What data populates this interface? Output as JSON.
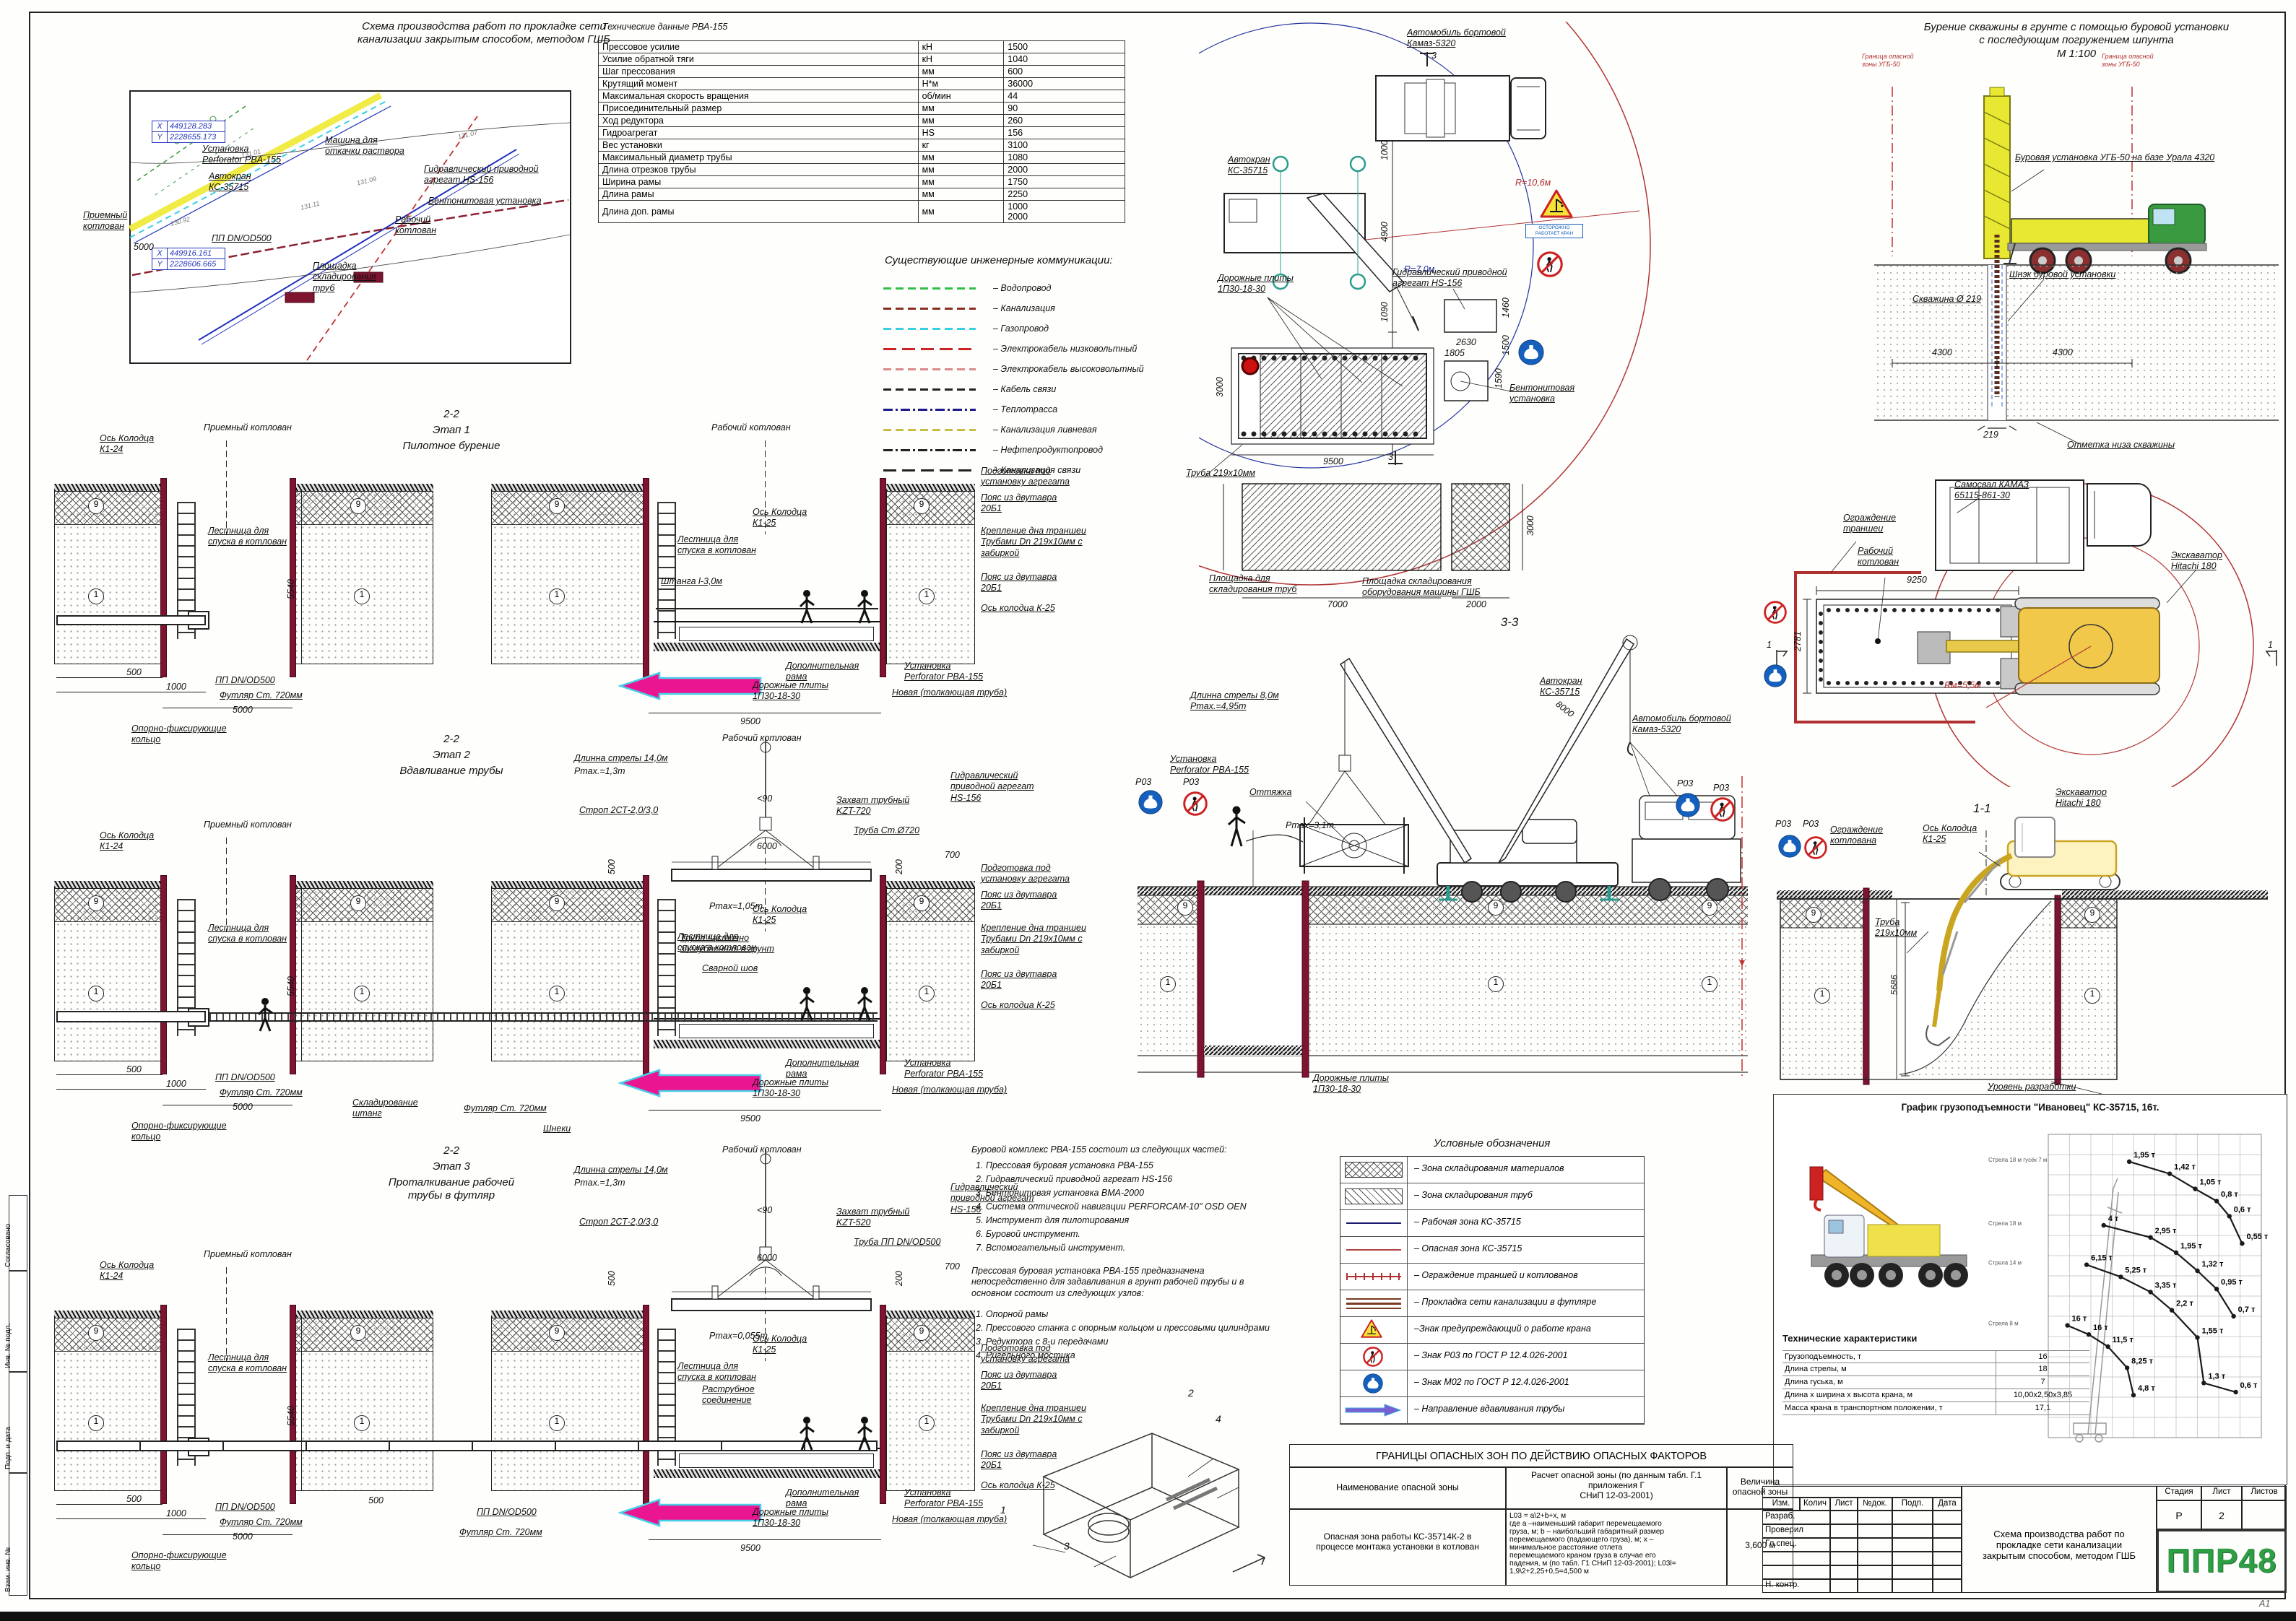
{
  "sheet": {
    "format": "А1"
  },
  "site_plan": {
    "title": "Схема производства работ по прокладке сети\nканализации закрытым способом, методом ГШБ",
    "coord_box1": {
      "x_label": "X",
      "x": "449128.283",
      "y_label": "Y",
      "y": "2228655.173"
    },
    "coord_box2": {
      "x_label": "X",
      "x": "449916.161",
      "y_label": "Y",
      "y": "2228606.665"
    },
    "labels": {
      "pump": "Машина для\nоткачки раствора",
      "perforator": "Установка\nPerforator PBA-155",
      "crane": "Автокран\nКС-35715",
      "hydro": "Гидравлический приводной\nагрегат HS-156",
      "bentonite": "Бентонитовая установка",
      "work_pit": "Рабочий\nкотлован",
      "recv_pit": "Приемный\nкотлован",
      "pp": "ПП DN/OD500",
      "storage": "Площадка\nскладирования\nтруб",
      "dim5000": "5000"
    },
    "spots": [
      "131.01",
      "131.11",
      "130.92",
      "131.07",
      "131.09"
    ]
  },
  "tech_table": {
    "title": "Технические данные РВА-155",
    "rows": [
      [
        "Прессовое усилие",
        "кН",
        "1500"
      ],
      [
        "Усилие обратной тяги",
        "кН",
        "1040"
      ],
      [
        "Шаг прессования",
        "мм",
        "600"
      ],
      [
        "Крутящий момент",
        "Н*м",
        "36000"
      ],
      [
        "Максимальная скорость вращения",
        "об/мин",
        "44"
      ],
      [
        "Присоединительный размер",
        "мм",
        "90"
      ],
      [
        "Ход редуктора",
        "мм",
        "260"
      ],
      [
        "Гидроагрегат",
        "HS",
        "156"
      ],
      [
        "Вес установки",
        "кг",
        "3100"
      ],
      [
        "Максимальный диаметр трубы",
        "мм",
        "1080"
      ],
      [
        "Длина отрезков трубы",
        "мм",
        "2000"
      ],
      [
        "Ширина рамы",
        "мм",
        "1750"
      ],
      [
        "Длина рамы",
        "мм",
        "2250"
      ],
      [
        "Длина доп. рамы",
        "мм",
        "1000\n2000"
      ]
    ]
  },
  "comms_legend": {
    "title": "Существующие инженерные коммуникации:",
    "items": [
      {
        "label": "– Водопровод",
        "color": "#2fbf4a",
        "style": "dash"
      },
      {
        "label": "– Канализация",
        "color": "#8a3020",
        "style": "dash"
      },
      {
        "label": "– Газопровод",
        "color": "#38cfe0",
        "style": "dash"
      },
      {
        "label": "– Электрокабель  низковольтный",
        "color": "#cc2525",
        "style": "longdash"
      },
      {
        "label": "– Электрокабель  высоковольтный",
        "color": "#d98a8a",
        "style": "dash"
      },
      {
        "label": "– Кабель  связи",
        "color": "#222222",
        "style": "dash"
      },
      {
        "label": "– Теплотрасса",
        "color": "#1a1a8c",
        "style": "dashdot"
      },
      {
        "label": "– Канализация  ливневая",
        "color": "#c9bc45",
        "style": "dash"
      },
      {
        "label": "– Нефтепродуктопровод",
        "color": "#222222",
        "style": "dashdot"
      },
      {
        "label": "– Канализация  связи",
        "color": "#222222",
        "style": "longdash"
      }
    ]
  },
  "plan_view": {
    "kamaz": "Автомобиль  бортовой\nКамаз-5320",
    "sec3": "3",
    "crane": "Автокран\nКС-35715",
    "plates": "Дорожные плиты\n1П30-18-30",
    "hydro": "Гидравлический приводной\nагрегат HS-156",
    "r_red": "R=10,6м",
    "r_blue": "R=7,0м",
    "truba": "Труба 219x10мм",
    "storage_pipes": "Площадка для\nскладирования  труб",
    "storage_equip": "Площадка складирования\nоборудования машины ГШБ",
    "bentonite": "Бентонитовая\nустановка",
    "warn_caption": "ОСТОРОЖНО\nРАБОТАЕТ КРАН",
    "d1000": "1000",
    "d4900": "4900",
    "d1090": "1090",
    "d9500": "9500",
    "d3000": "3000",
    "d2630": "2630",
    "d1460": "1460",
    "d1805": "1805",
    "d1500": "1500",
    "d1590": "1590",
    "d7000": "7000",
    "d2000": "2000"
  },
  "drill_view": {
    "title": "Бурение скважины в грунте с помощью буровой установки\nс последующим погружением шпунта\nМ 1:100",
    "rig": "Буровая установка УГБ-50 на базе Урала 4320",
    "auger": "Шнэк буровой установки",
    "well": "Скважина Ø 219",
    "bottom": "Отметка низа скважины",
    "bound": "Граница опасной\nзоны УГБ-50",
    "d4300a": "4300",
    "d4300b": "4300",
    "d219": "219"
  },
  "stage_common": {
    "priem": "Приемный котлован",
    "rab": "Рабочий котлован",
    "os24": "Ось  Колодца\nК1-24",
    "os25": "Ось  Колодца\nК1-25",
    "ladder": "Лестница для\nспуска в котлован",
    "d500": "500",
    "d1000": "1000",
    "d5000": "5000",
    "d5540": "5540",
    "d9500": "9500",
    "pp": "ПП DN/OD500",
    "futlyar": "Футляр Ст. 720мм",
    "ring": "Опорно-фиксирующие\nкольцо",
    "dop_rama": "Дополнительная\nрама",
    "plates": "Дорожные плиты\n1П30-18-30",
    "unit": "Установка\nPerforator PBA-155",
    "unit2": "Новая (толкающая труба)",
    "note1": "Подготовка под\nустановку агрегата",
    "note2": "Пояс из двутавра\n20Б1",
    "note3": "Крепление дна траншеи\nТрубами Dn 219x10мм с\nзабиркой",
    "note4": "Пояс из двутавра\n20Б1",
    "os_k25": "Ось колодца К-25",
    "g9": "9",
    "g1": "1"
  },
  "stages": [
    {
      "code": "2-2",
      "name": "Этап 1",
      "desc": "Пилотное бурение",
      "shtanga": "Штанга l-3,0м"
    },
    {
      "code": "2-2",
      "name": "Этап 2",
      "desc": "Вдавливание трубы",
      "boom": "Длинна стрелы 14,0м",
      "pmax_hook": "Pmax.=1,3m",
      "strop": "Строп 2СТ-2,0/3,0",
      "angle": "<90",
      "zahvat": "Захват трубный\nKZT-720",
      "truba": "Труба Ст.Ø720",
      "hs": "Гидравлический\nприводной агрегат\nHS-156",
      "d6000": "6000",
      "d500b": "500",
      "d200": "200",
      "d700": "700",
      "pmax_in": "Pmax=1,05m.",
      "truba_part": "Труба частично\nзаглубленная в грунт",
      "svar": "Сварной шов",
      "sklad": "Складирование\nштанг",
      "futlyar2": "Футляр Ст. 720мм",
      "shneki": "Шнеки"
    },
    {
      "code": "2-2",
      "name": "Этап 3",
      "desc": "Проталкивание рабочей\nтрубы в футляр",
      "boom": "Длинна стрелы 14,0м",
      "pmax_hook": "Pmax.=1,3m",
      "strop": "Строп 2СТ-2,0/3,0",
      "angle": "<90",
      "zahvat": "Захват трубный\nKZT-520",
      "truba": "Труба ПП DN/OD500",
      "hs": "Гидравлический\nприводной агрегат\nHS-156",
      "d6000": "6000",
      "d500b": "500",
      "d200": "200",
      "d700": "700",
      "pmax_in": "Pmax=0,055m.",
      "rastrub": "Раструбное\nсоединение",
      "pp2": "ПП DN/OD500",
      "futlyar2": "Футляр Ст. 720мм",
      "d500c": "500"
    }
  ],
  "section33": {
    "title": "3-3",
    "boom_note": "Длинна стрелы 8,0м\nPmax.=4,95m",
    "d8000": "8000",
    "crane": "Автокран\nКС-35715",
    "kamaz": "Автомобиль  бортовой\nКамаз-5320",
    "unit": "Установка\nPerforator PBA-155",
    "guy": "Оттяжка",
    "pmax": "Pmax=3,1m.",
    "p03": "Р03",
    "plates": "Дорожные плиты\n1П30-18-30",
    "g9": "9",
    "g1": "1"
  },
  "excavator_plan": {
    "samosval": "Самосвал  КАМАЗ\n65115-861-30",
    "fence": "Ограждение\nтраншеи",
    "pit": "Рабочий\nкотлован",
    "excavator": "Экскаватор\nHitachi  180",
    "d9250": "9250",
    "d2781": "2781",
    "radius": "Rм=5,5м",
    "mark": "1"
  },
  "section11": {
    "title": "1-1",
    "axis": "Ось  Колодца\nК1-25",
    "excavator": "Экскаватор\nHitachi  180",
    "p03": "Р03",
    "fence": "Ограждение\nкотлована",
    "pipe": "Труба\n219х10мм",
    "d5686": "5686",
    "level": "Уровень разработки",
    "g9": "9",
    "g1": "1"
  },
  "symbols_legend": {
    "title": "Условные обозначения",
    "items": [
      {
        "label": "– Зона складирования материалов",
        "type": "xhatch"
      },
      {
        "label": "– Зона складирования труб",
        "type": "diag"
      },
      {
        "label": "– Рабочая зона КС-35715",
        "type": "line_navy"
      },
      {
        "label": "– Опасная зона КС-35715",
        "type": "line_red"
      },
      {
        "label": "– Ограждение траншей и котлованов",
        "type": "fence"
      },
      {
        "label": "– Прокладка сети канализации в футляре",
        "type": "triple"
      },
      {
        "label": "–Знак предупреждающий о работе крана",
        "type": "warn"
      },
      {
        "label": "– Знак Р03 по ГОСТ Р 12.4.026-2001",
        "type": "p03"
      },
      {
        "label": "– Знак М02 по ГОСТ Р 12.4.026-2001",
        "type": "m02"
      },
      {
        "label": "– Направление вдавливания трубы",
        "type": "arrow"
      }
    ]
  },
  "complex_text": {
    "head": "Буровой комплекс РВА-155 состоит из следующих частей:",
    "items": [
      "1. Прессовая буровая установка РВА-155",
      "2. Гидравлический приводной агрегат HS-156",
      "3. Бентонитовая установка  ВМА-2000",
      "4. Система оптической навигации PERFORCAM-10\" OSD OEN",
      "5. Инструмент для пилотирования",
      "6. Буровой инструмент.",
      "7. Вспомогательный инструмент."
    ],
    "head2": "Прессовая буровая установка РВА-155 предназначена\nнепосредственно для задавливания в грунт рабочей трубы и в\nосновном состоит из следующих узлов:",
    "items2": [
      "1. Опорной рамы",
      "2. Прессового станка с опорным кольцом и прессовыми цилиндрами",
      "3. Редуктора с 8-и передачами",
      "4. Ригельного мостика"
    ],
    "marks": [
      "1",
      "2",
      "3",
      "4"
    ]
  },
  "chart_data": {
    "type": "line",
    "title": "График грузоподъемности \"Ивановец\" КС-35715, 16т.",
    "xlabel": "вылет, м",
    "ylabel": "высота, м",
    "legend_position": "left",
    "grid": true,
    "series": [
      {
        "name": "Стрела 18 м\nгусёк 7 м",
        "points": [
          [
            38,
            9,
            "1,95 т"
          ],
          [
            57,
            13,
            "1,42 т"
          ],
          [
            69,
            18,
            "1,05 т"
          ],
          [
            79,
            22,
            "0,8 т"
          ],
          [
            85,
            27,
            "0,6 т"
          ],
          [
            91,
            36,
            "0,55 т"
          ]
        ]
      },
      {
        "name": "Стрела 18 м",
        "points": [
          [
            26,
            30,
            "4 т"
          ],
          [
            48,
            34,
            "2,95 т"
          ],
          [
            60,
            39,
            "1,95 т"
          ],
          [
            70,
            45,
            "1,32 т"
          ],
          [
            79,
            51,
            "0,95 т"
          ],
          [
            87,
            60,
            "0,7 т"
          ]
        ]
      },
      {
        "name": "Стрела 14 м",
        "points": [
          [
            18,
            43,
            "6,15 т"
          ],
          [
            34,
            47,
            "5,25 т"
          ],
          [
            48,
            52,
            "3,35 т"
          ],
          [
            58,
            58,
            "2,2 т"
          ],
          [
            70,
            67,
            "1,55 т"
          ],
          [
            73,
            82,
            "1,3 т"
          ],
          [
            88,
            85,
            "0,6 т"
          ]
        ]
      },
      {
        "name": "Стрела 8 м",
        "points": [
          [
            9,
            63,
            "16 т"
          ],
          [
            19,
            66,
            "16 т"
          ],
          [
            28,
            70,
            "11,5 т"
          ],
          [
            37,
            77,
            "8,25 т"
          ],
          [
            40,
            86,
            "4,8 т"
          ]
        ]
      }
    ]
  },
  "crane_specs": {
    "title": "Технические характеристики",
    "rows": [
      [
        "Грузоподъемность, т",
        "16"
      ],
      [
        "Длина стрелы, м",
        "18"
      ],
      [
        "Длина гуська, м",
        "7"
      ],
      [
        "Длина х ширина х высота крана, м",
        "10,00х2,50х3,85"
      ],
      [
        "Масса крана в транспортном положении, т",
        "17,1"
      ]
    ]
  },
  "danger_table": {
    "title": "ГРАНИЦЫ ОПАСНЫХ ЗОН ПО ДЕЙСТВИЮ ОПАСНЫХ ФАКТОРОВ",
    "h1": "Наименование опасной зоны",
    "h2": "Расчет опасной зоны (по данным табл. Г.1\nприложения Г\nСНиП 12-03-2001)",
    "h3": "Величина\nопасной зоны",
    "r1": "Опасная зона работы КС-35714К-2 в\nпроцессе монтажа установки в котлован",
    "r2": "L03 = a\\2+b+x, м\nгде а –наименьший габарит перемещаемого\nгруза, м; b – наибольший габаритный размер\nперемещаемого (падающего груза), м; х –\nминимальное расстояние отлета\nперемещаемого краном груза в случае его\nпадения, м (по табл. Г1 СНиП 12-03-2001); L03l=\n1,9\\2+2,25+0,5=4,500 м",
    "r3": "3,600 м"
  },
  "title_block": {
    "cols": [
      "Изм.",
      "Колич",
      "Лист",
      "№док.",
      "Подп.",
      "Дата"
    ],
    "rows": [
      "Разраб.",
      "Проверил",
      "Гл.спец.",
      "",
      "",
      "Н. контр."
    ],
    "stage_h": "Стадия",
    "sheet_h": "Лист",
    "sheets_h": "Листов",
    "stage_v": "Р",
    "sheet_v": "2",
    "sheets_v": "",
    "doc_title": "Схема производства работ по\nпрокладке сети канализации\nзакрытым способом, методом ГШБ",
    "logo": "ППР48",
    "format": "А1"
  },
  "frame": {
    "side_labels": [
      "Согласовано",
      "Инв. № подл.",
      "Подп. и дата",
      "Взам. инв. №"
    ]
  }
}
